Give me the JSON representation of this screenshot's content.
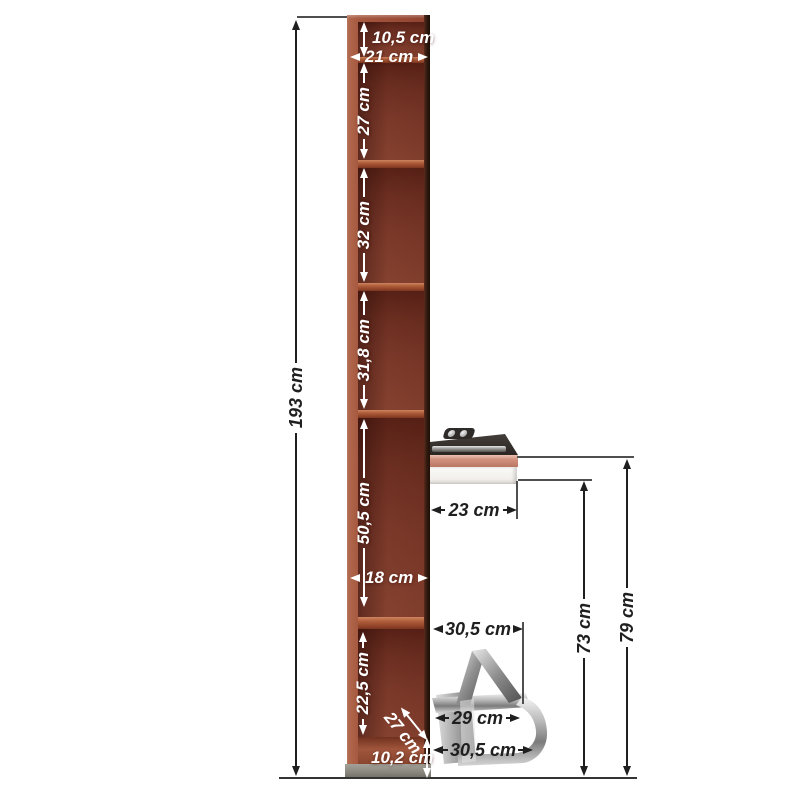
{
  "diagram": {
    "name": "wall-mounted wardrobe column with fold-out desk and chrome footrest - dimension drawing",
    "unit": "cm"
  },
  "labels": {
    "total_height": "193 cm",
    "top_inset": "10,5 cm",
    "inner_width": "21 cm",
    "comp1": "27 cm",
    "comp2": "32 cm",
    "comp3": "31,8 cm",
    "comp4": "50,5 cm",
    "inner_width_lower": "18 cm",
    "comp5": "22,5 cm",
    "depth": "27 cm",
    "base_height": "10,2 cm",
    "desk_depth": "23 cm",
    "desk_clearance_height": "73 cm",
    "desk_top_height": "79 cm",
    "footrest_top_width": "30,5 cm",
    "footrest_mid_width": "29 cm",
    "footrest_bottom_width": "30,5 cm"
  },
  "colors": {
    "background": "#ffffff",
    "wood_frame": "#a65840",
    "wood_interior": "#6f3022",
    "wood_divider": "#b05f3b",
    "side_shadow": "#1d0e06",
    "plinth_gray": "#8b897f",
    "desk_top": "#37312e",
    "desk_edge_band": "#d2927f",
    "drawer_white": "#f2efec",
    "chrome": "#c9c9c9",
    "dim_dark": "#1f1f1f",
    "dim_white": "#ffffff"
  }
}
